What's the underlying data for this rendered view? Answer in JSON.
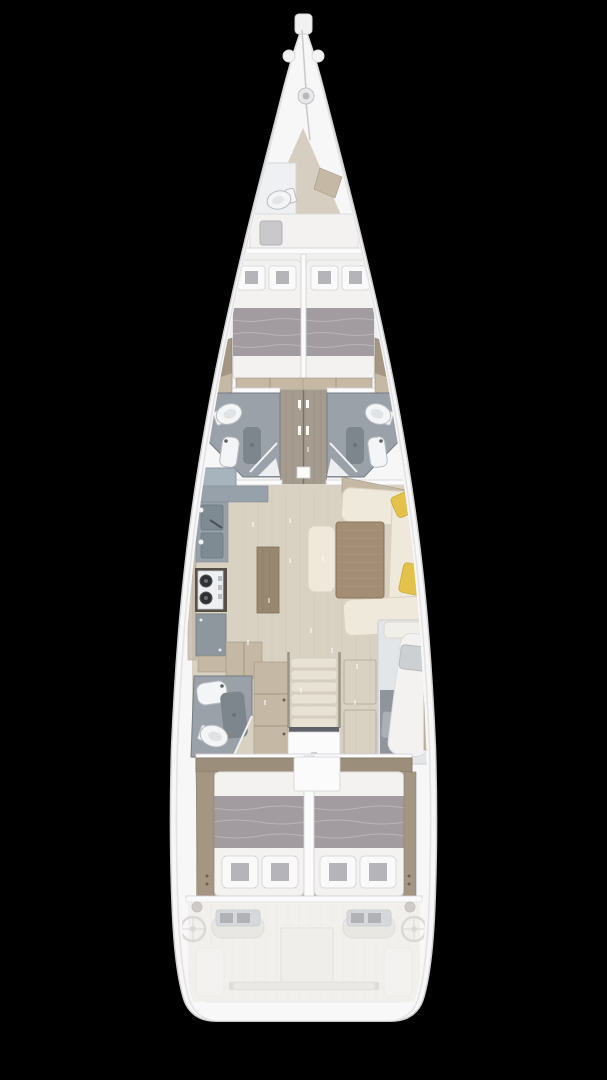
{
  "canvas": {
    "width": "607",
    "height": "1080"
  },
  "colors": {
    "background": "#000000",
    "hull": "#f7f7f8",
    "hullEdge": "#cfcfd2",
    "deckLine": "#e3e3e5",
    "floorWood": "#d9d2c3",
    "floorWoodDark": "#a59c8f",
    "woodTrim": "#c5b9a5",
    "woodTrimDark": "#a39783",
    "shelfBrown": "#9b8f7c",
    "mattress": "#f3f2f0",
    "blanket": "#a29ca0",
    "pillowSquare": "#b5b4b8",
    "bathFloor": "#9aa1a8",
    "bathFixture": "#f4f5f6",
    "showerMat": "#7d868d",
    "counterGray": "#97a1a9",
    "sinkBasin": "#7f8b93",
    "stoveDark": "#565049",
    "burner": "#2e3134",
    "cabinetGray": "#8e979e",
    "islandWood": "#998871",
    "tableWood": "#a38d74",
    "sofaCream": "#efe9db",
    "pillowYellow": "#e3c14b",
    "stairCream": "#e8e2d4",
    "cockpitFloor": "#e9e2d5",
    "consoleGray": "#9aa0a5",
    "wheel": "#a8a193"
  },
  "vessel": {
    "type": "sailing-yacht-interior-floor-plan",
    "orientation": "bow-at-top",
    "sections": {
      "bow": [
        "anchor-roller",
        "windlass",
        "anchor-chain"
      ],
      "forepeak": [
        "crew-toilet",
        "corner-locker",
        "crew-berth",
        "berth-pillow"
      ],
      "forward_cabins": [
        "port-bed",
        "starboard-bed",
        "two-pillows-per-bed",
        "gray-blankets",
        "side-wardrobes"
      ],
      "forward_heads": [
        "port-toilet",
        "port-vanity-sink",
        "port-shower",
        "starboard-toilet",
        "starboard-vanity-sink",
        "starboard-shower",
        "corridor-with-two-doors"
      ],
      "salon": [
        "galley-double-sink",
        "galley-stove-two-burners",
        "galley-counters",
        "center-island",
        "dinette-table",
        "u-shaped-sofa",
        "bench-seat",
        "two-yellow-cushions"
      ],
      "midship": [
        "aft-head-toilet",
        "aft-head-sink",
        "aft-head-shower",
        "wardrobe",
        "companionway-stairs",
        "engine-hatch",
        "starboard-single-berth"
      ],
      "aft_cabins": [
        "port-double-bed",
        "starboard-double-bed",
        "two-pillows-per-bed",
        "center-partition"
      ],
      "cockpit": [
        "port-helm-wheel",
        "starboard-helm-wheel",
        "twin-instrument-consoles",
        "cockpit-table-hatch",
        "mainsheet-traveler",
        "winches",
        "side-benches",
        "swim-platform"
      ]
    }
  }
}
